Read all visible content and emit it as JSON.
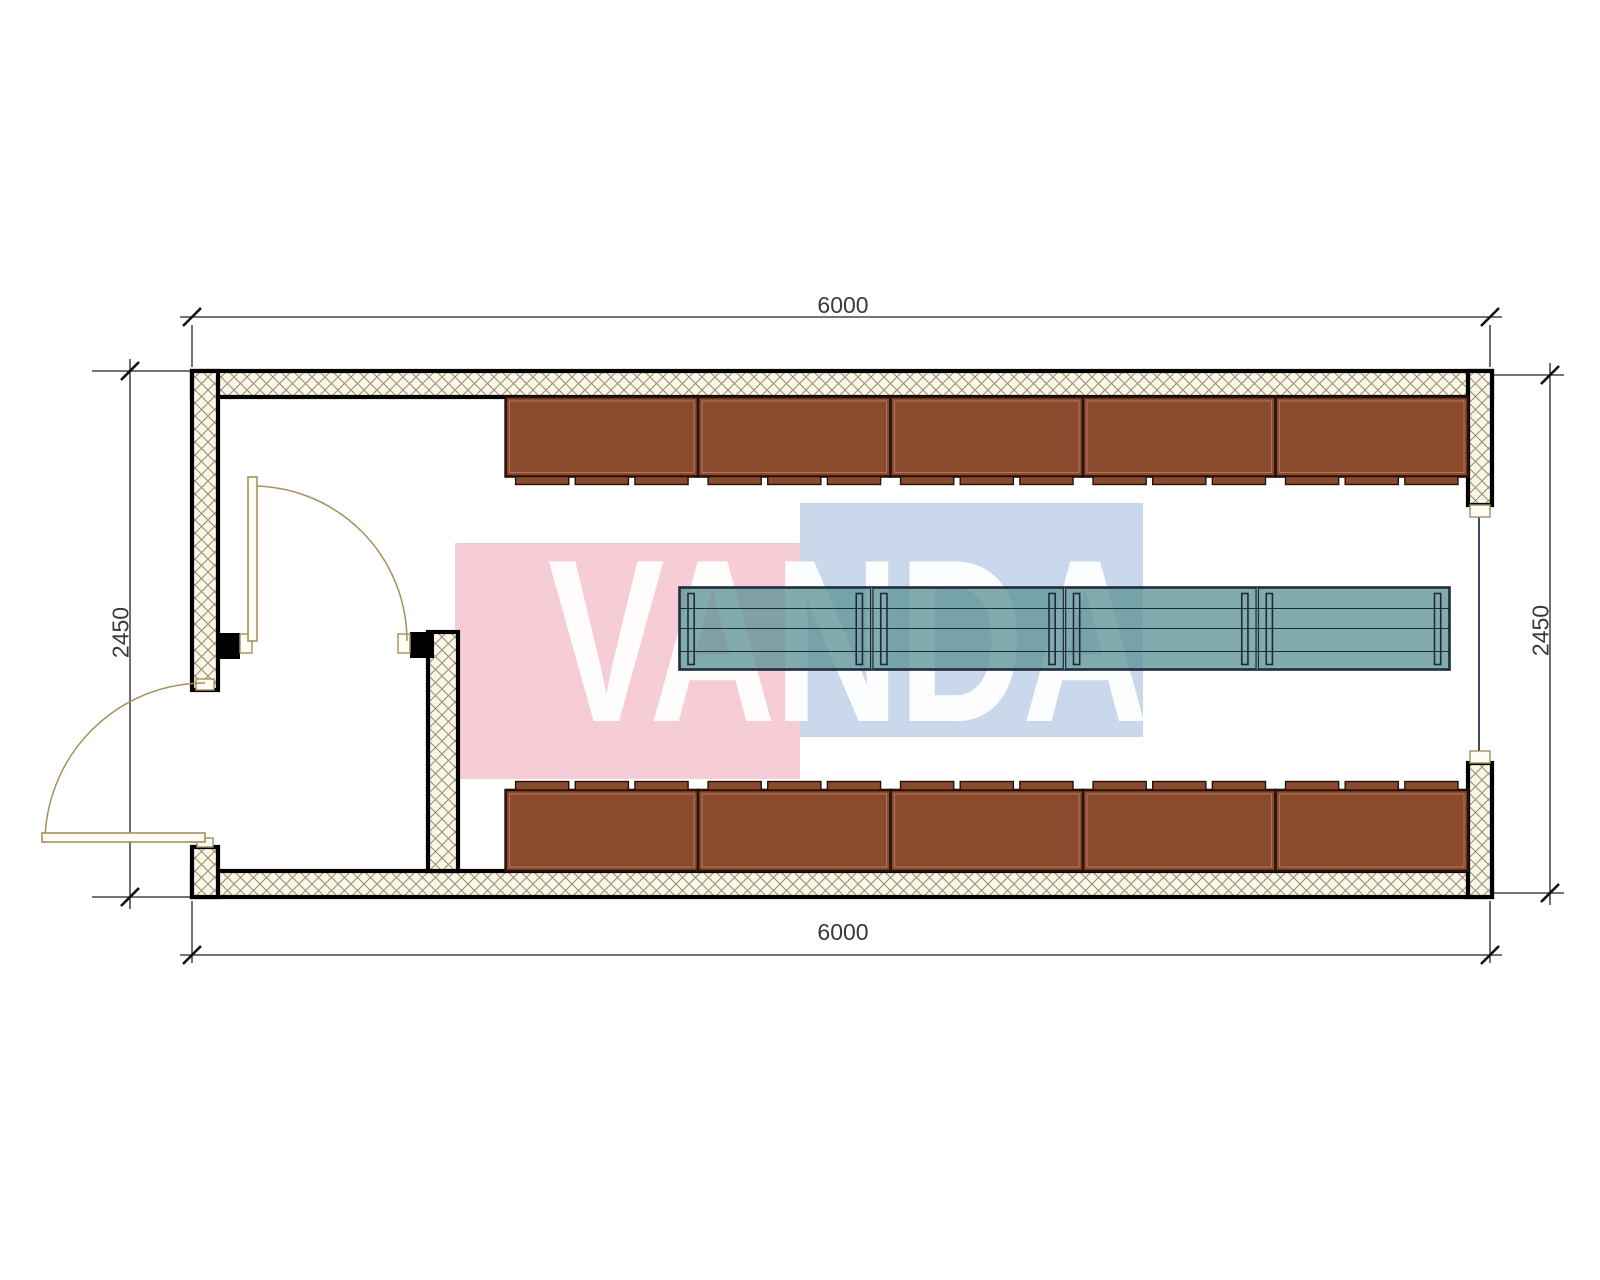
{
  "watermark": {
    "text": "VANDA",
    "pink_color": "#f6cdd6",
    "blue_color": "#c9d8ea",
    "letter_color": "rgba(255,255,255,0.93)"
  },
  "dimensions": {
    "top": "6000",
    "bottom": "6000",
    "left": "2450",
    "right": "2450"
  },
  "furniture": {
    "top_cabinet_count": 5,
    "bottom_cabinet_count": 5,
    "bench_section_count": 4,
    "tabs_per_cabinet": 3,
    "legs_per_bench_section": 2
  },
  "palette": {
    "background": "#ffffff",
    "wall_edge": "#000000",
    "hatch_bg": "#faf6e8",
    "hatch_line": "#968c6c",
    "cabinet_fill": "#8a4a2e",
    "cabinet_border": "#27120a",
    "cabinet_inner_line": "#b5765a",
    "bench_fill": "#5f9396",
    "bench_border": "#1b2a3c",
    "door_frame": "#a6905c",
    "door_leaf_fill": "#fffdf4",
    "opening_line": "#2a3550",
    "dim_line": "#222222",
    "dim_text": "#3a3a3a"
  }
}
